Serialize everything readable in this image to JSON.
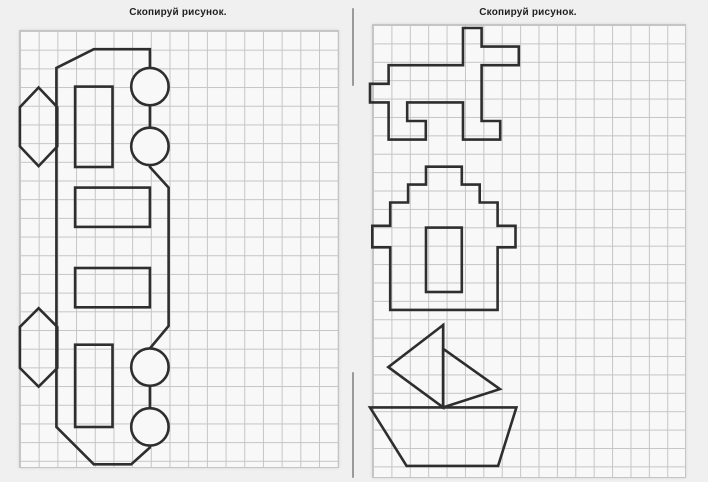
{
  "left": {
    "title": "Скопируй рисунок."
  },
  "right": {
    "title": "Скопируй рисунок."
  },
  "colors": {
    "page_bg": "#f0f0f0",
    "paper": "#f8f8f8",
    "grid_line": "#c5c5c5",
    "stroke": "#2e2e2e",
    "divider": "#9a9a9a",
    "title": "#1f1f1f"
  },
  "figures": [
    {
      "id": "bus",
      "name": "bus-side-view-rotated-vertical",
      "origin": [
        19,
        30.5
      ],
      "unit": 18.7,
      "shapes": [
        {
          "kind": "polygon",
          "pts": [
            [
              2,
              2
            ],
            [
              4,
              1
            ],
            [
              7,
              1
            ],
            [
              7,
              7.3
            ],
            [
              8,
              8.4
            ],
            [
              8,
              15.8
            ],
            [
              7,
              17
            ],
            [
              7,
              22.3
            ],
            [
              6,
              23.2
            ],
            [
              4,
              23.2
            ],
            [
              2,
              21.2
            ]
          ]
        },
        {
          "kind": "circle",
          "cx": 7,
          "cy": 3,
          "r": 1,
          "fill": "paper"
        },
        {
          "kind": "circle",
          "cx": 7,
          "cy": 6.2,
          "r": 1,
          "fill": "paper"
        },
        {
          "kind": "circle",
          "cx": 7,
          "cy": 18,
          "r": 1,
          "fill": "paper"
        },
        {
          "kind": "circle",
          "cx": 7,
          "cy": 21.2,
          "r": 1,
          "fill": "paper"
        },
        {
          "kind": "rect",
          "x": 3,
          "y": 3,
          "w": 2,
          "h": 4.3
        },
        {
          "kind": "rect",
          "x": 3,
          "y": 8.4,
          "w": 4,
          "h": 2.1
        },
        {
          "kind": "rect",
          "x": 3,
          "y": 12.7,
          "w": 4,
          "h": 2.1
        },
        {
          "kind": "rect",
          "x": 3,
          "y": 16.8,
          "w": 2,
          "h": 4.4
        },
        {
          "kind": "polygon",
          "pts": [
            [
              1.05,
              3.05
            ],
            [
              2.05,
              4.1
            ],
            [
              2.05,
              6.2
            ],
            [
              1.05,
              7.25
            ],
            [
              0.05,
              6.2
            ],
            [
              0.05,
              4.1
            ]
          ]
        },
        {
          "kind": "polygon",
          "pts": [
            [
              1.05,
              14.85
            ],
            [
              2.05,
              15.85
            ],
            [
              2.05,
              18.05
            ],
            [
              1.05,
              19.05
            ],
            [
              0.05,
              18.05
            ],
            [
              0.05,
              15.85
            ]
          ]
        }
      ]
    },
    {
      "id": "polyomino-animal",
      "name": "stepped-polyomino-animal",
      "origin": [
        370,
        28
      ],
      "unit": 18.6,
      "shapes": [
        {
          "kind": "polygon",
          "pts": [
            [
              5,
              0
            ],
            [
              6,
              0
            ],
            [
              6,
              1
            ],
            [
              8,
              1
            ],
            [
              8,
              2
            ],
            [
              6,
              2
            ],
            [
              6,
              5
            ],
            [
              7,
              5
            ],
            [
              7,
              6
            ],
            [
              5,
              6
            ],
            [
              5,
              4
            ],
            [
              2,
              4
            ],
            [
              2,
              5
            ],
            [
              3,
              5
            ],
            [
              3,
              6
            ],
            [
              1,
              6
            ],
            [
              1,
              4
            ],
            [
              0,
              4
            ],
            [
              0,
              3
            ],
            [
              1,
              3
            ],
            [
              1,
              2
            ],
            [
              5,
              2
            ]
          ]
        }
      ]
    },
    {
      "id": "house",
      "name": "stepped-roof-house-with-door",
      "origin": [
        372.3,
        166.7
      ],
      "unit": 17.9,
      "shapes": [
        {
          "kind": "polygon",
          "pts": [
            [
              3,
              0
            ],
            [
              5,
              0
            ],
            [
              5,
              1
            ],
            [
              6,
              1
            ],
            [
              6,
              2
            ],
            [
              7,
              2
            ],
            [
              7,
              3.3
            ],
            [
              8,
              3.3
            ],
            [
              8,
              4.5
            ],
            [
              7,
              4.5
            ],
            [
              7,
              8
            ],
            [
              1,
              8
            ],
            [
              1,
              4.5
            ],
            [
              0,
              4.5
            ],
            [
              0,
              3.3
            ],
            [
              1,
              3.3
            ],
            [
              1,
              2
            ],
            [
              2,
              2
            ],
            [
              2,
              1
            ],
            [
              3,
              1
            ]
          ]
        },
        {
          "kind": "rect",
          "x": 3,
          "y": 3.4,
          "w": 2,
          "h": 3.6
        }
      ]
    },
    {
      "id": "sailboat",
      "name": "sailboat-with-two-sails",
      "origin": [
        370,
        325
      ],
      "unit": 18.3,
      "shapes": [
        {
          "kind": "polygon",
          "pts": [
            [
              0,
              4.5
            ],
            [
              8,
              4.5
            ],
            [
              7,
              7.7
            ],
            [
              2,
              7.7
            ]
          ]
        },
        {
          "kind": "line",
          "a": [
            4,
            0
          ],
          "b": [
            4,
            4.5
          ]
        },
        {
          "kind": "polygon",
          "pts": [
            [
              4,
              0
            ],
            [
              1,
              2.3
            ],
            [
              4,
              4.5
            ]
          ]
        },
        {
          "kind": "polygon",
          "pts": [
            [
              4,
              1.3
            ],
            [
              7.1,
              3.5
            ],
            [
              4,
              4.5
            ]
          ]
        }
      ]
    }
  ]
}
